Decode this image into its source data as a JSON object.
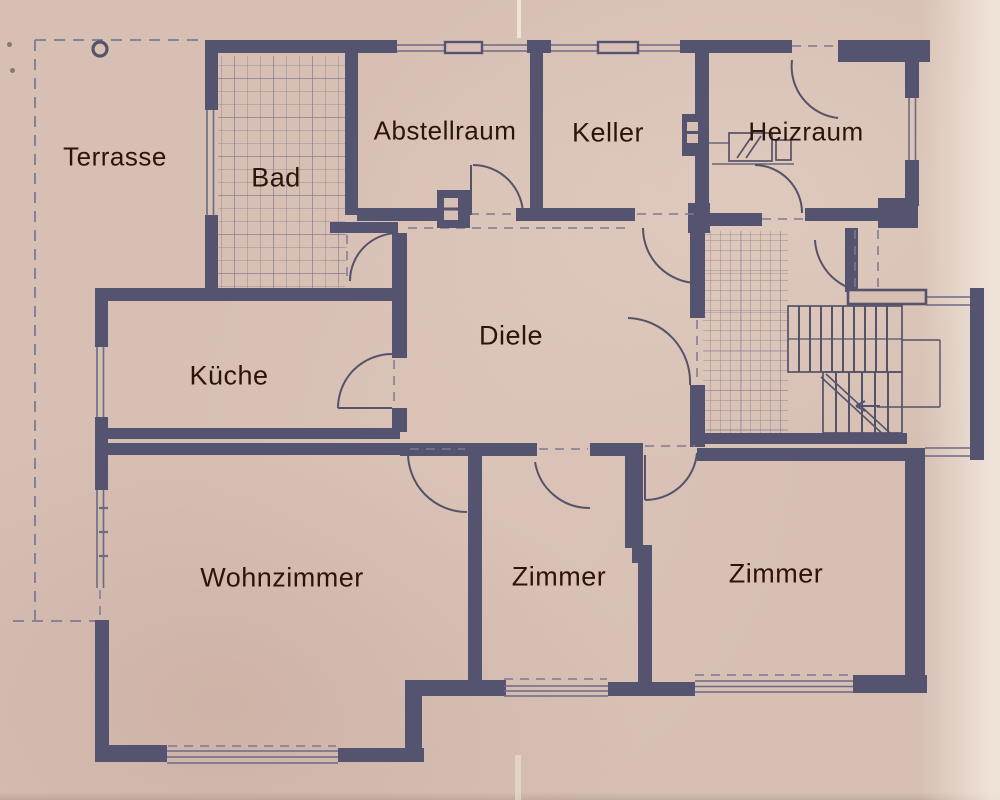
{
  "drawing": {
    "type": "floor-plan",
    "language": "de"
  },
  "palette": {
    "paper": "#d7bfb4",
    "wall": "#555470",
    "thin_line": "#6c6a85",
    "dash_line": "#7d7a93",
    "tile_line": "#5f5a7d",
    "label_text": "#2d140a"
  },
  "rooms": [
    {
      "id": "terrasse",
      "label": "Terrasse"
    },
    {
      "id": "bad",
      "label": "Bad"
    },
    {
      "id": "abstellraum",
      "label": "Abstellraum"
    },
    {
      "id": "keller",
      "label": "Keller"
    },
    {
      "id": "heizraum",
      "label": "Heizraum"
    },
    {
      "id": "diele",
      "label": "Diele"
    },
    {
      "id": "kueche",
      "label": "Küche"
    },
    {
      "id": "wohnzimmer",
      "label": "Wohnzimmer"
    },
    {
      "id": "zimmer1",
      "label": "Zimmer"
    },
    {
      "id": "zimmer2",
      "label": "Zimmer"
    }
  ],
  "symbols": {
    "terrace_marker": "circle-outline-symbol",
    "chimney_flues": 2,
    "heater_units": 2,
    "stair_direction": "arrow-left",
    "door_arcs": 10
  }
}
